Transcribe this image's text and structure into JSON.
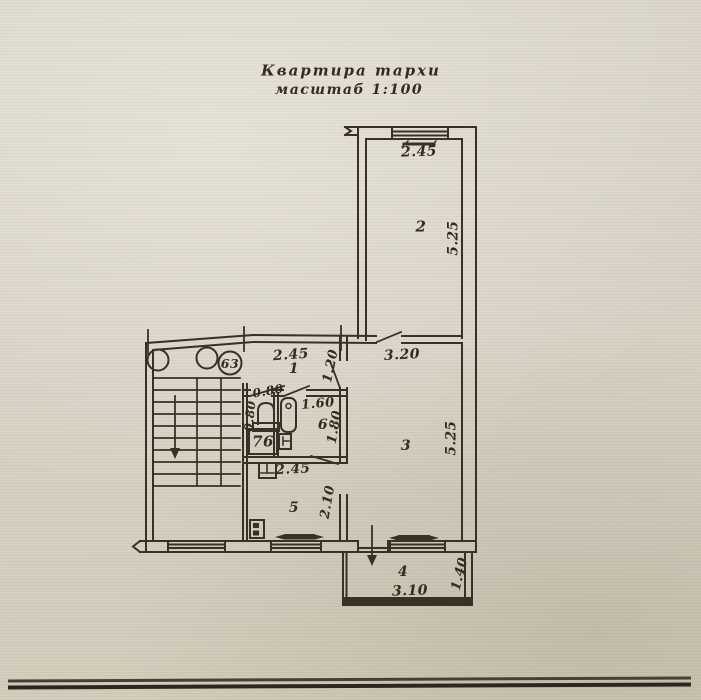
{
  "title": {
    "line1": "Квартира тархи",
    "line2": "масштаб 1:100"
  },
  "stairwell_badge": "63",
  "wc_box_label": "76",
  "rooms": {
    "room1": "1",
    "room2": "2",
    "room3": "3",
    "room4": "4",
    "room5": "5",
    "room6": "6"
  },
  "dims": {
    "room2_width": "2.45",
    "room2_depth": "5.25",
    "hall_width": "2.45",
    "hall_depth": "1.20",
    "room3_width": "3.20",
    "room3_depth": "5.25",
    "wc_door": "0.80",
    "wc_width": "0.80",
    "bath_width": "1.60",
    "bath_depth": "1.80",
    "kitchen_width": "2.45",
    "kitchen_depth": "2.10",
    "balcony_width": "3.10",
    "balcony_depth": "1.40"
  },
  "colors": {
    "paper": "#d9d3c7",
    "ink": "#3a3126"
  }
}
